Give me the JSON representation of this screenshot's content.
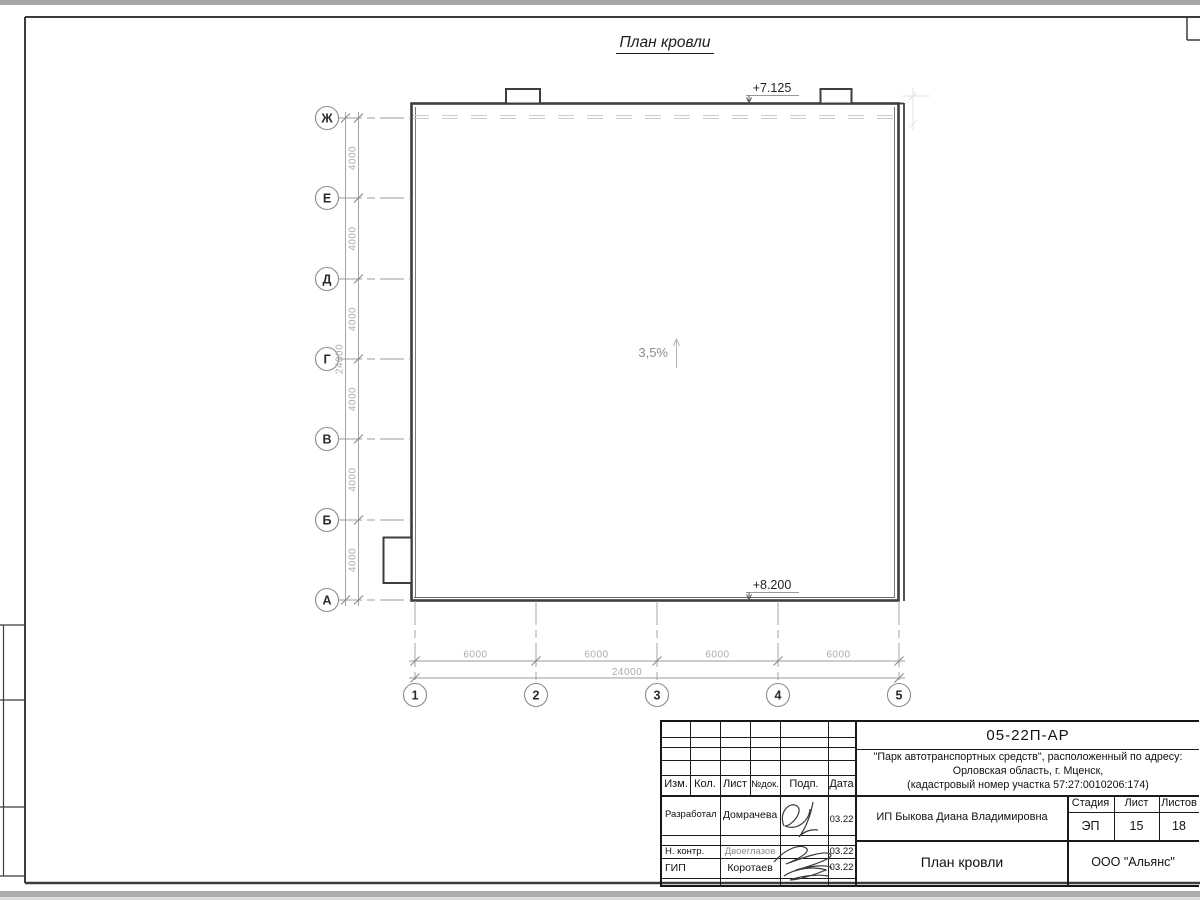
{
  "page": {
    "title": "План кровли"
  },
  "plan": {
    "elevation_top": "+7.125",
    "elevation_bottom": "+8.200",
    "slope": "3,5%"
  },
  "axes": {
    "row_labels": [
      "Ж",
      "Е",
      "Д",
      "Г",
      "В",
      "Б",
      "А"
    ],
    "col_labels": [
      "1",
      "2",
      "3",
      "4",
      "5"
    ],
    "row_dims": [
      "4000",
      "4000",
      "4000",
      "4000",
      "4000",
      "4000"
    ],
    "row_total": "24000",
    "col_dims": [
      "6000",
      "6000",
      "6000",
      "6000"
    ],
    "col_total": "24000"
  },
  "title_block": {
    "doc_number": "05-22П-АР",
    "project_address_line1": "\"Парк автотранспортных средств\",  расположенный по адресу:",
    "project_address_line2": "Орловская область, г. Мценск,",
    "project_address_line3": "(кадастровый номер участка 57:27:0010206:174)",
    "columns": {
      "izm": "Изм.",
      "kol": "Кол.",
      "list": "Лист",
      "ndok": "№док.",
      "podp": "Подп.",
      "data": "Дата"
    },
    "signers": [
      {
        "role": "Разработал",
        "name": "Домрачева",
        "date": "03.22"
      },
      {
        "role": "Н. контр.",
        "name": "Двоеглазов",
        "date": "03.22"
      },
      {
        "role": "ГИП",
        "name": "Коротаев",
        "date": "03.22"
      }
    ],
    "client": "ИП Быкова Диана Владимировна",
    "stage_label": "Стадия",
    "sheet_label": "Лист",
    "sheets_label": "Листов",
    "stage_value": "ЭП",
    "sheet_value": "15",
    "sheets_value": "18",
    "drawing_title": "План кровли",
    "company": "ООО \"Альянс\""
  }
}
